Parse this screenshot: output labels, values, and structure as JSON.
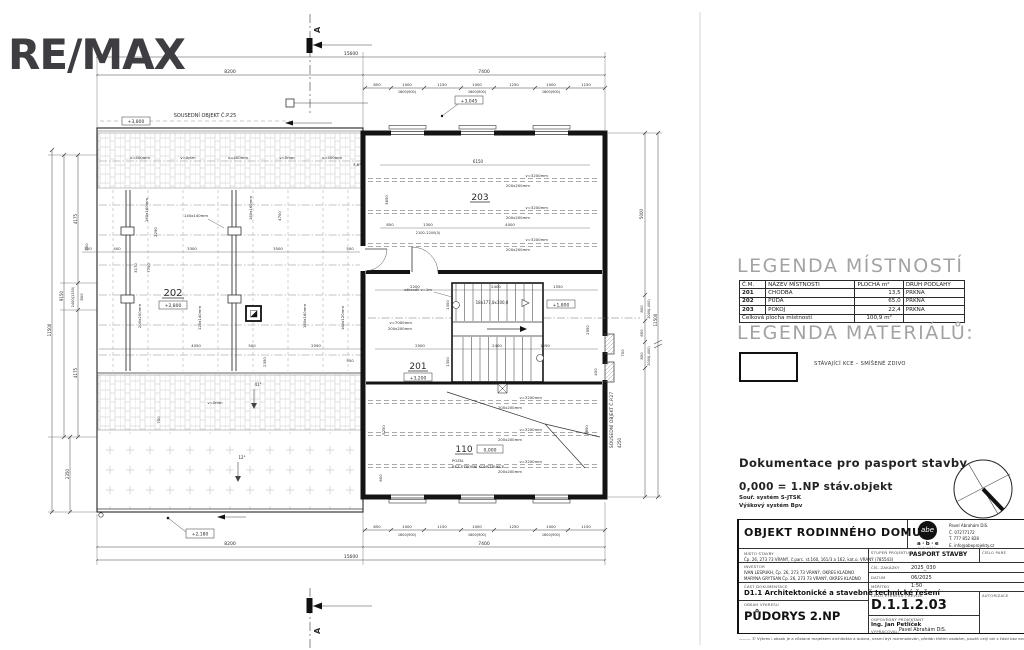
{
  "logo": {
    "brand": "RE/MAX"
  },
  "legend_rooms": {
    "title": "LEGENDA MÍSTNOSTÍ",
    "headers": [
      "Č.M.",
      "NÁZEV MÍSTNOSTI",
      "PLOCHA m²",
      "DRUH PODLAHY"
    ],
    "rows": [
      [
        "201",
        "CHODBA",
        "13,5",
        "PRKNA"
      ],
      [
        "202",
        "PŮDA",
        "65,0",
        "PRKNA"
      ],
      [
        "203",
        "POKOJ",
        "22,4",
        "PRKNA"
      ]
    ],
    "total_label": "Celková plocha místností",
    "total_value": "100,9 m²"
  },
  "legend_materials": {
    "title": "LEGENDA MATERIÁLŮ:",
    "item1": "STÁVAJÍCÍ KCE – SMÍŠENÉ ZDIVO"
  },
  "doc_info": {
    "line1": "Dokumentace pro pasport stavby",
    "line2": "0,000 = 1.NP stáv.objekt",
    "line3": "Souř. systém S-JTSK",
    "line4": "Výškový systém Bpv"
  },
  "title_block": {
    "project_title": "OBJEKT RODINNÉHO DOMU",
    "misto_label": "MÍSTO STAVBY",
    "misto": "Čp. 26, 273 73 VRANÝ, č.parc. st.160, 161/3 a 162, kat.ú. VRANÝ (785543)",
    "investor_label": "INVESTOR",
    "investor1": "IVAN LESPUKH, Čp. 26, 273 73 VRANÝ, OKRES KLADNO",
    "investor2": "MARYNA GRYTSAN Čp. 26, 273 73 VRANÝ, OKRES KLADNO",
    "cast_label": "ČÁST DOKUMENTACE",
    "cast": "D1.1 Architektonické a stavebně technické řešení",
    "obsah_label": "OBSAH VÝKRESU",
    "obsah": "PŮDORYS 2.NP",
    "stupen_label": "STUPEŇ PROJEKTU",
    "stupen": "PASPORT STAVBY",
    "pare_label": "ČÍSLO PARÉ",
    "zakazka_label": "ČÍS. ZAKÁZKY",
    "zakazka": "2025_030",
    "datum_label": "DATUM",
    "datum": "06/2025",
    "meritko_label": "MĚŘÍTKO",
    "meritko": "1:50",
    "cislo_label": "ČÍSLO VÝKRESU / REVIZE",
    "autorizace_label": "AUTORIZACE",
    "cislo": "D.1.1.2.03",
    "odpovedny_label": "ODPOVĚDNÝ PROJEKTANT",
    "odpovedny": "Ing. Jan Petlíček",
    "vypracoval_label": "VYPRACOVAL:",
    "vypracoval": "Pavel Abrahám DiS.",
    "firm_mark": "abe",
    "firm_name": "a·b·e",
    "firm_sub": "projekty",
    "contact_name": "Pavel Abrahám DiS.",
    "contact_ic": "Č. 07277172",
    "contact_tel": "T. 777 852 828",
    "contact_email": "E. info@abeprojekty.cz",
    "disclaimer": "——— © Výkres i obsah je a zůstane majetkem architekta a autora, nesmí být rozmnožován, předán třetím osobám, použit celý ani z části bez architektova písemného souhlasu"
  },
  "plan": {
    "sectionA": "A",
    "dimTotal": "15600",
    "dimLeft": "8200",
    "dimRight": "7400",
    "w850": "850",
    "w1000": "1000",
    "w1150": "1150",
    "w1250": "1250",
    "w1600": "1600(900)",
    "neighborTop": "SOUSEDNÍ OBJEKT Č.P.25",
    "neighborRight": "SOUSEDNÍ OBJEKT Č.P.27",
    "lvl3800": "+3,800",
    "lvl3045": "+3,045",
    "lvl2800": "+2,800",
    "lvl3200": "+3,200",
    "lvl1800": "+1,800",
    "lvl2180": "+2,180",
    "lvl0": "0,000",
    "room202": "202",
    "room203": "203",
    "room201": "201",
    "room110": "110",
    "pozn": "POZN.",
    "bezStropni": "BEZ STROPNÍ KONSTRUKCE",
    "stairSpec": "18x177,8x300,0",
    "railing": "zábradlí v=1m",
    "beam200": "200x200mm",
    "v3200": "v=3200mm",
    "v7000": "v=7000mm",
    "beam160": "160x160mm",
    "beam140": "140x140mm",
    "beam120": "120x140mm",
    "beam160120": "160x120mm",
    "v400": "v=400mm",
    "v0": "v=0mm",
    "ang38": "3,8°",
    "ang41": "41°",
    "ang12": "12°",
    "door2100": "2100–2200(0)",
    "d6150": "6150",
    "d3650": "3650",
    "d850": "850",
    "d1300": "1300",
    "d4000": "4000",
    "d2200": "2200",
    "d2400": "2400",
    "d1550": "1550",
    "d2500": "2500",
    "d1250": "1250",
    "d5250": "5250",
    "d2850": "2850",
    "d2950": "2950",
    "d450": "450",
    "d4050": "4050",
    "d500": "500",
    "d2050": "2050",
    "d2350": "2350",
    "d550": "550",
    "d3300": "3300",
    "d3500": "3500",
    "d400": "400",
    "d3170": "3170",
    "d7750": "7750",
    "d2290": "2290",
    "d4700": "4700",
    "d4175": "4175",
    "d9150": "9150",
    "d800": "800",
    "d1400": "1400(1150)",
    "d5000": "5000",
    "d650": "650",
    "d700": "700",
    "d2000": "2000(-400)",
    "d11500": "11500",
    "d4250": "4250",
    "d600": "600"
  }
}
